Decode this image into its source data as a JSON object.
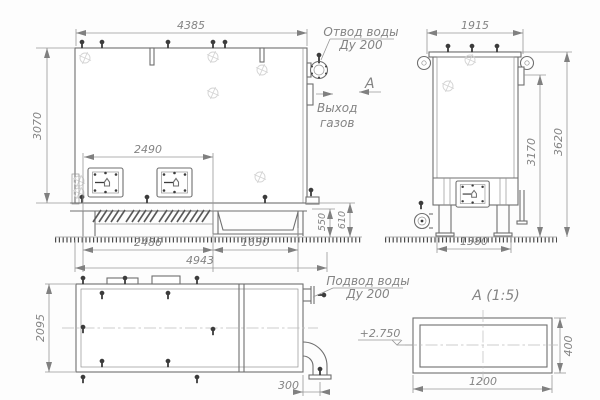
{
  "front_view": {
    "dim_top": "4385",
    "dim_left": "3070",
    "dim_doors": "2490",
    "dim_base_left": "2486",
    "dim_trough": "1630",
    "dim_overall": "4943",
    "dim_h550": "550",
    "dim_h610": "610",
    "water_outlet_l1": "Отвод воды",
    "water_outlet_l2": "Ду 200",
    "gas_exit_l1": "Выход",
    "gas_exit_l2": "газов",
    "section_mark": "А"
  },
  "side_view": {
    "dim_top": "1915",
    "dim_h3170": "3170",
    "dim_h3620": "3620",
    "dim_legs": "1380"
  },
  "plan_view": {
    "dim_left": "2095",
    "dim_pipe": "300",
    "water_supply_l1": "Подвод воды",
    "water_supply_l2": "Ду 200"
  },
  "section_a": {
    "title": "А  (1:5)",
    "dim_w": "1200",
    "dim_h": "400",
    "elevation": "+2.750"
  }
}
